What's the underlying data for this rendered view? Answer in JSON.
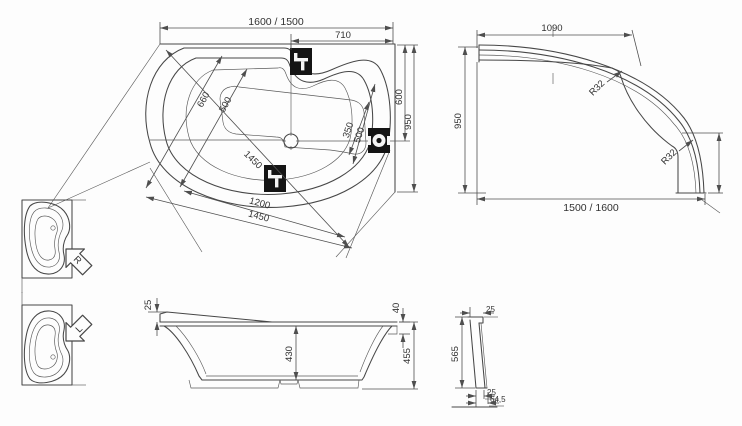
{
  "drawing_title": "asymmetric corner bathtub technical drawing",
  "colors": {
    "background": "#fdfdfd",
    "line": "#474747",
    "fitting_fill": "#141414"
  },
  "plan": {
    "dim_overall_length": "1600 / 1500",
    "dim_faucet_offset": "710",
    "dim_end_width": "600",
    "dim_overall_width": "950",
    "dim_inner_width_outer": "660",
    "dim_inner_width_inner": "500",
    "dim_diagonal_length": "1450",
    "dim_drain_to_edge_inner": "350",
    "dim_drain_to_edge_outer": "500",
    "dim_bottom_inner": "1200",
    "dim_bottom_outer": "1450"
  },
  "apron": {
    "dim_top_length": "1090",
    "dim_height": "950",
    "dim_radius_upper": "R32",
    "dim_radius_lower": "R32",
    "dim_bottom_length": "1500 / 1600"
  },
  "front": {
    "dim_rim_thickness": "25",
    "dim_rim_drop": "40",
    "dim_inner_depth": "430",
    "dim_total_height": "455"
  },
  "section": {
    "dim_top_thickness": "25",
    "dim_panel_height": "565",
    "dim_bottom_thickness": "25",
    "dim_bottom_width": "64,5"
  },
  "orientation": {
    "right_version_label": "R",
    "left_version_label": "L"
  }
}
